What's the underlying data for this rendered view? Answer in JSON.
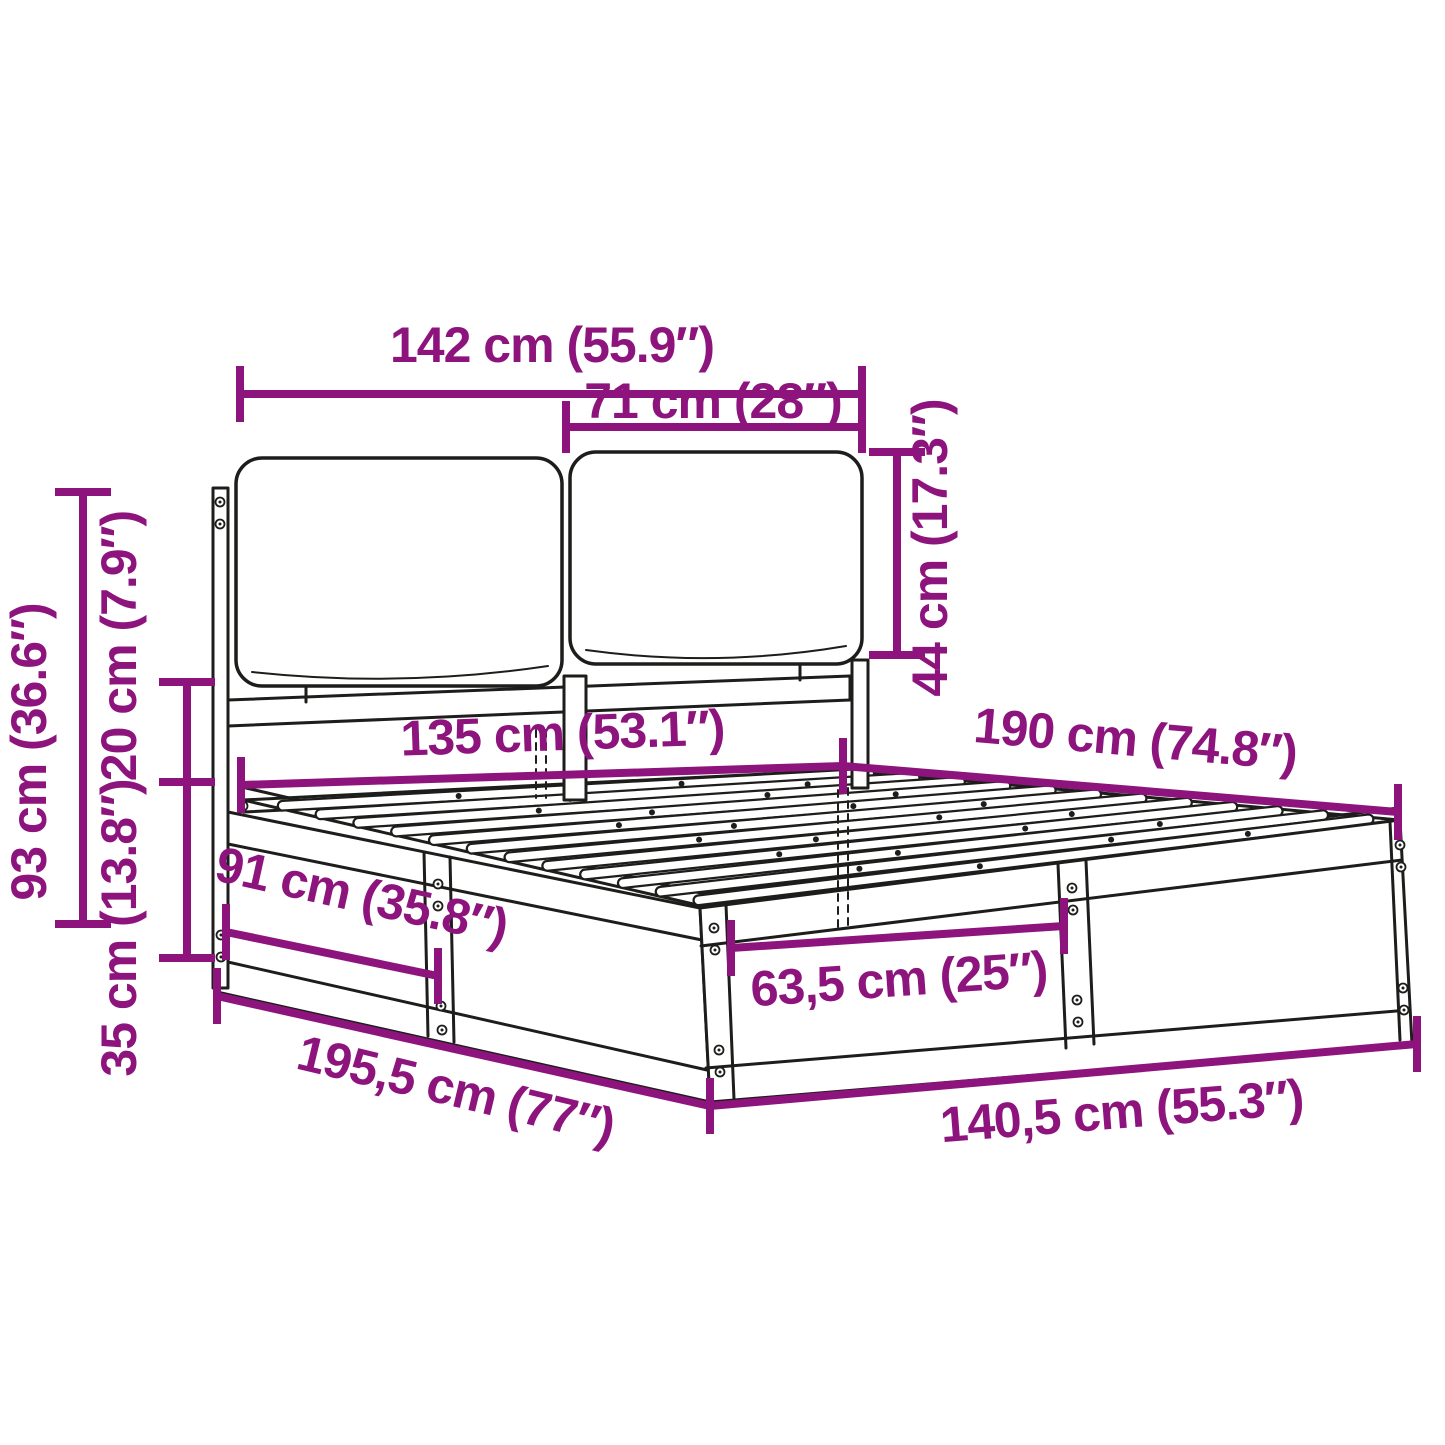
{
  "figure": {
    "type": "technical-dimension-diagram",
    "subject": "bed frame with cushioned headboard and slatted base",
    "background_color": "#ffffff",
    "drawing_line_color": "#1d1d1b",
    "dimension_color": "#8E147D"
  },
  "dimensions": [
    {
      "id": "headboard-total-width",
      "label": "142 cm (55.9″)"
    },
    {
      "id": "cushion-width",
      "label": "71 cm (28″)"
    },
    {
      "id": "cushion-height",
      "label": "44 cm (17.3″)"
    },
    {
      "id": "headboard-height",
      "label": "93 cm (36.6″)"
    },
    {
      "id": "gap-height",
      "label": "20 cm (7.9″)"
    },
    {
      "id": "frame-side-height",
      "label": "35 cm (13.8″)"
    },
    {
      "id": "inner-width",
      "label": "135 cm (53.1″)"
    },
    {
      "id": "inner-length",
      "label": "190 cm (74.8″)"
    },
    {
      "id": "side-section-length",
      "label": "91 cm (35.8″)"
    },
    {
      "id": "foot-section-width",
      "label": "63,5 cm (25″)"
    },
    {
      "id": "total-length",
      "label": "195,5 cm (77″)"
    },
    {
      "id": "total-width",
      "label": "140,5 cm (55.3″)"
    }
  ]
}
